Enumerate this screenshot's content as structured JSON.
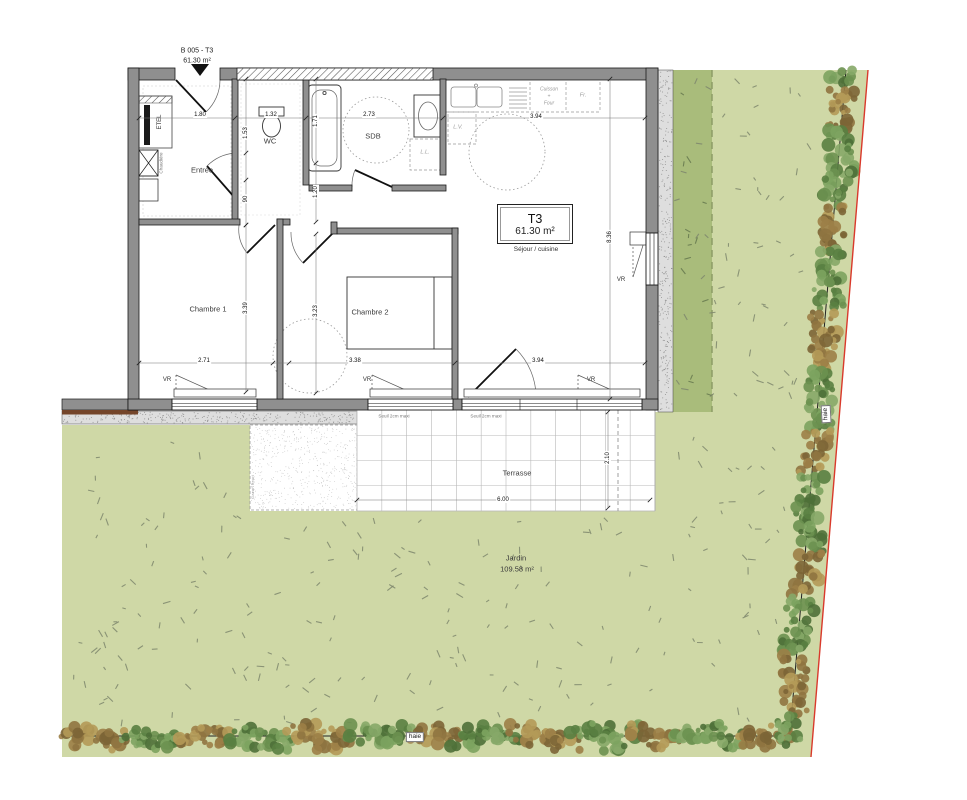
{
  "title_block": {
    "ref": "B 005 - T3",
    "area": "61.30 m²"
  },
  "unit": {
    "type": "T3",
    "area": "61.30 m²",
    "main_room": "Séjour / cuisine"
  },
  "hedge": {
    "label": "haie"
  },
  "colors": {
    "garden": "#cfd8a6",
    "garden_dark": "#a9bc7b",
    "gravel": "#dedede",
    "wall": "#8f8f8f",
    "boundary_red": "#d93a2c",
    "hedge_green": "#6b9150",
    "hedge_brown": "#9c8047",
    "speckle": "#7e876d"
  },
  "labels": [
    {
      "n": "title-ref",
      "t": "B 005 - T3",
      "x": 197,
      "y": 51,
      "cls": "ref"
    },
    {
      "n": "title-area",
      "t": "61.30 m²",
      "x": 197,
      "y": 61,
      "cls": "ref"
    },
    {
      "n": "room-entree",
      "t": "Entrée",
      "x": 202,
      "y": 170,
      "cls": "room"
    },
    {
      "n": "room-wc",
      "t": "WC",
      "x": 270,
      "y": 141,
      "cls": "room"
    },
    {
      "n": "room-sdb",
      "t": "SDB",
      "x": 373,
      "y": 136,
      "cls": "room"
    },
    {
      "n": "room-chambre1",
      "t": "Chambre 1",
      "x": 208,
      "y": 309,
      "cls": "room"
    },
    {
      "n": "room-chambre2",
      "t": "Chambre 2",
      "x": 370,
      "y": 312,
      "cls": "room"
    },
    {
      "n": "label-sejour-cuisine",
      "t": "Séjour / cuisine",
      "x": 536,
      "y": 250,
      "cls": "area2"
    },
    {
      "n": "label-terrasse",
      "t": "Terrasse",
      "x": 517,
      "y": 473,
      "cls": "room"
    },
    {
      "n": "label-jardin",
      "t": "Jardin",
      "x": 516,
      "y": 558,
      "cls": "room"
    },
    {
      "n": "label-jardin-area",
      "t": "109.58 m²",
      "x": 517,
      "y": 569,
      "cls": "room"
    },
    {
      "n": "label-etel",
      "t": "ETEL",
      "x": 160,
      "y": 122,
      "rot": -90,
      "cls": "vr"
    },
    {
      "n": "label-chaudiere",
      "t": "Chaudière",
      "x": 162,
      "y": 163,
      "rot": -90,
      "cls": "tiny"
    },
    {
      "n": "label-lave-linge",
      "t": "L.L.",
      "x": 425,
      "y": 153,
      "cls": "small"
    },
    {
      "n": "label-lave-vaisselle",
      "t": "L.V.",
      "x": 458,
      "y": 128,
      "cls": "small"
    },
    {
      "n": "label-cuisson-1",
      "t": "Cuisson",
      "x": 549,
      "y": 90,
      "cls": "smallc"
    },
    {
      "n": "label-cuisson-2",
      "t": "+",
      "x": 549,
      "y": 97,
      "cls": "smallc"
    },
    {
      "n": "label-cuisson-3",
      "t": "Four",
      "x": 549,
      "y": 104,
      "cls": "smallc"
    },
    {
      "n": "label-frigo",
      "t": "Fr.",
      "x": 583,
      "y": 96,
      "cls": "small"
    },
    {
      "n": "vr-chambre1",
      "t": "VR",
      "x": 167,
      "y": 380,
      "cls": "vr"
    },
    {
      "n": "vr-chambre2",
      "t": "VR",
      "x": 367,
      "y": 380,
      "cls": "vr"
    },
    {
      "n": "vr-sejour",
      "t": "VR",
      "x": 591,
      "y": 380,
      "cls": "vr"
    },
    {
      "n": "vr-cuisine",
      "t": "VR",
      "x": 621,
      "y": 280,
      "cls": "vr"
    },
    {
      "n": "seuil-1",
      "t": "Seuil 2cm maxi",
      "x": 394,
      "y": 417,
      "cls": "tiny"
    },
    {
      "n": "seuil-2",
      "t": "Seuil 2cm maxi",
      "x": 486,
      "y": 417,
      "cls": "tiny"
    },
    {
      "n": "label-gazon",
      "t": "Gazon fleuri",
      "x": 253,
      "y": 487,
      "rot": -90,
      "cls": "tiny2"
    },
    {
      "n": "dim-entree-180",
      "t": "1.80",
      "x": 200,
      "y": 115,
      "cls": "dim"
    },
    {
      "n": "dim-wc-132",
      "t": "1.32",
      "x": 271,
      "y": 115,
      "cls": "dim"
    },
    {
      "n": "dim-sdb-273",
      "t": "2.73",
      "x": 369,
      "y": 115,
      "cls": "dim"
    },
    {
      "n": "dim-sejour-394-haut",
      "t": "3.94",
      "x": 536,
      "y": 117,
      "cls": "dim"
    },
    {
      "n": "dim-wc-153",
      "t": "1.53",
      "x": 246,
      "y": 133,
      "rot": -90,
      "cls": "dim"
    },
    {
      "n": "dim-porte-90",
      "t": "90",
      "x": 246,
      "y": 199,
      "rot": -90,
      "cls": "dim"
    },
    {
      "n": "dim-sdb-171",
      "t": "1.71",
      "x": 316,
      "y": 121,
      "rot": -90,
      "cls": "dim"
    },
    {
      "n": "dim-hall-120",
      "t": "1.20",
      "x": 316,
      "y": 192,
      "rot": -90,
      "cls": "dim"
    },
    {
      "n": "dim-sejour-836",
      "t": "8.36",
      "x": 610,
      "y": 237,
      "rot": -90,
      "cls": "dim"
    },
    {
      "n": "dim-chambre1-339",
      "t": "3.39",
      "x": 246,
      "y": 308,
      "rot": -90,
      "cls": "dim"
    },
    {
      "n": "dim-chambre2-323",
      "t": "3.23",
      "x": 316,
      "y": 311,
      "rot": -90,
      "cls": "dim"
    },
    {
      "n": "dim-chambre1-271",
      "t": "2.71",
      "x": 204,
      "y": 361,
      "cls": "dim"
    },
    {
      "n": "dim-chambre2-338",
      "t": "3.38",
      "x": 355,
      "y": 361,
      "cls": "dim"
    },
    {
      "n": "dim-sejour-394-bas",
      "t": "3.94",
      "x": 538,
      "y": 361,
      "cls": "dim"
    },
    {
      "n": "dim-terrasse-600",
      "t": "6.00",
      "x": 503,
      "y": 500,
      "cls": "dim"
    },
    {
      "n": "dim-terrasse-210",
      "t": "2.10",
      "x": 608,
      "y": 458,
      "rot": -90,
      "cls": "dim"
    }
  ]
}
